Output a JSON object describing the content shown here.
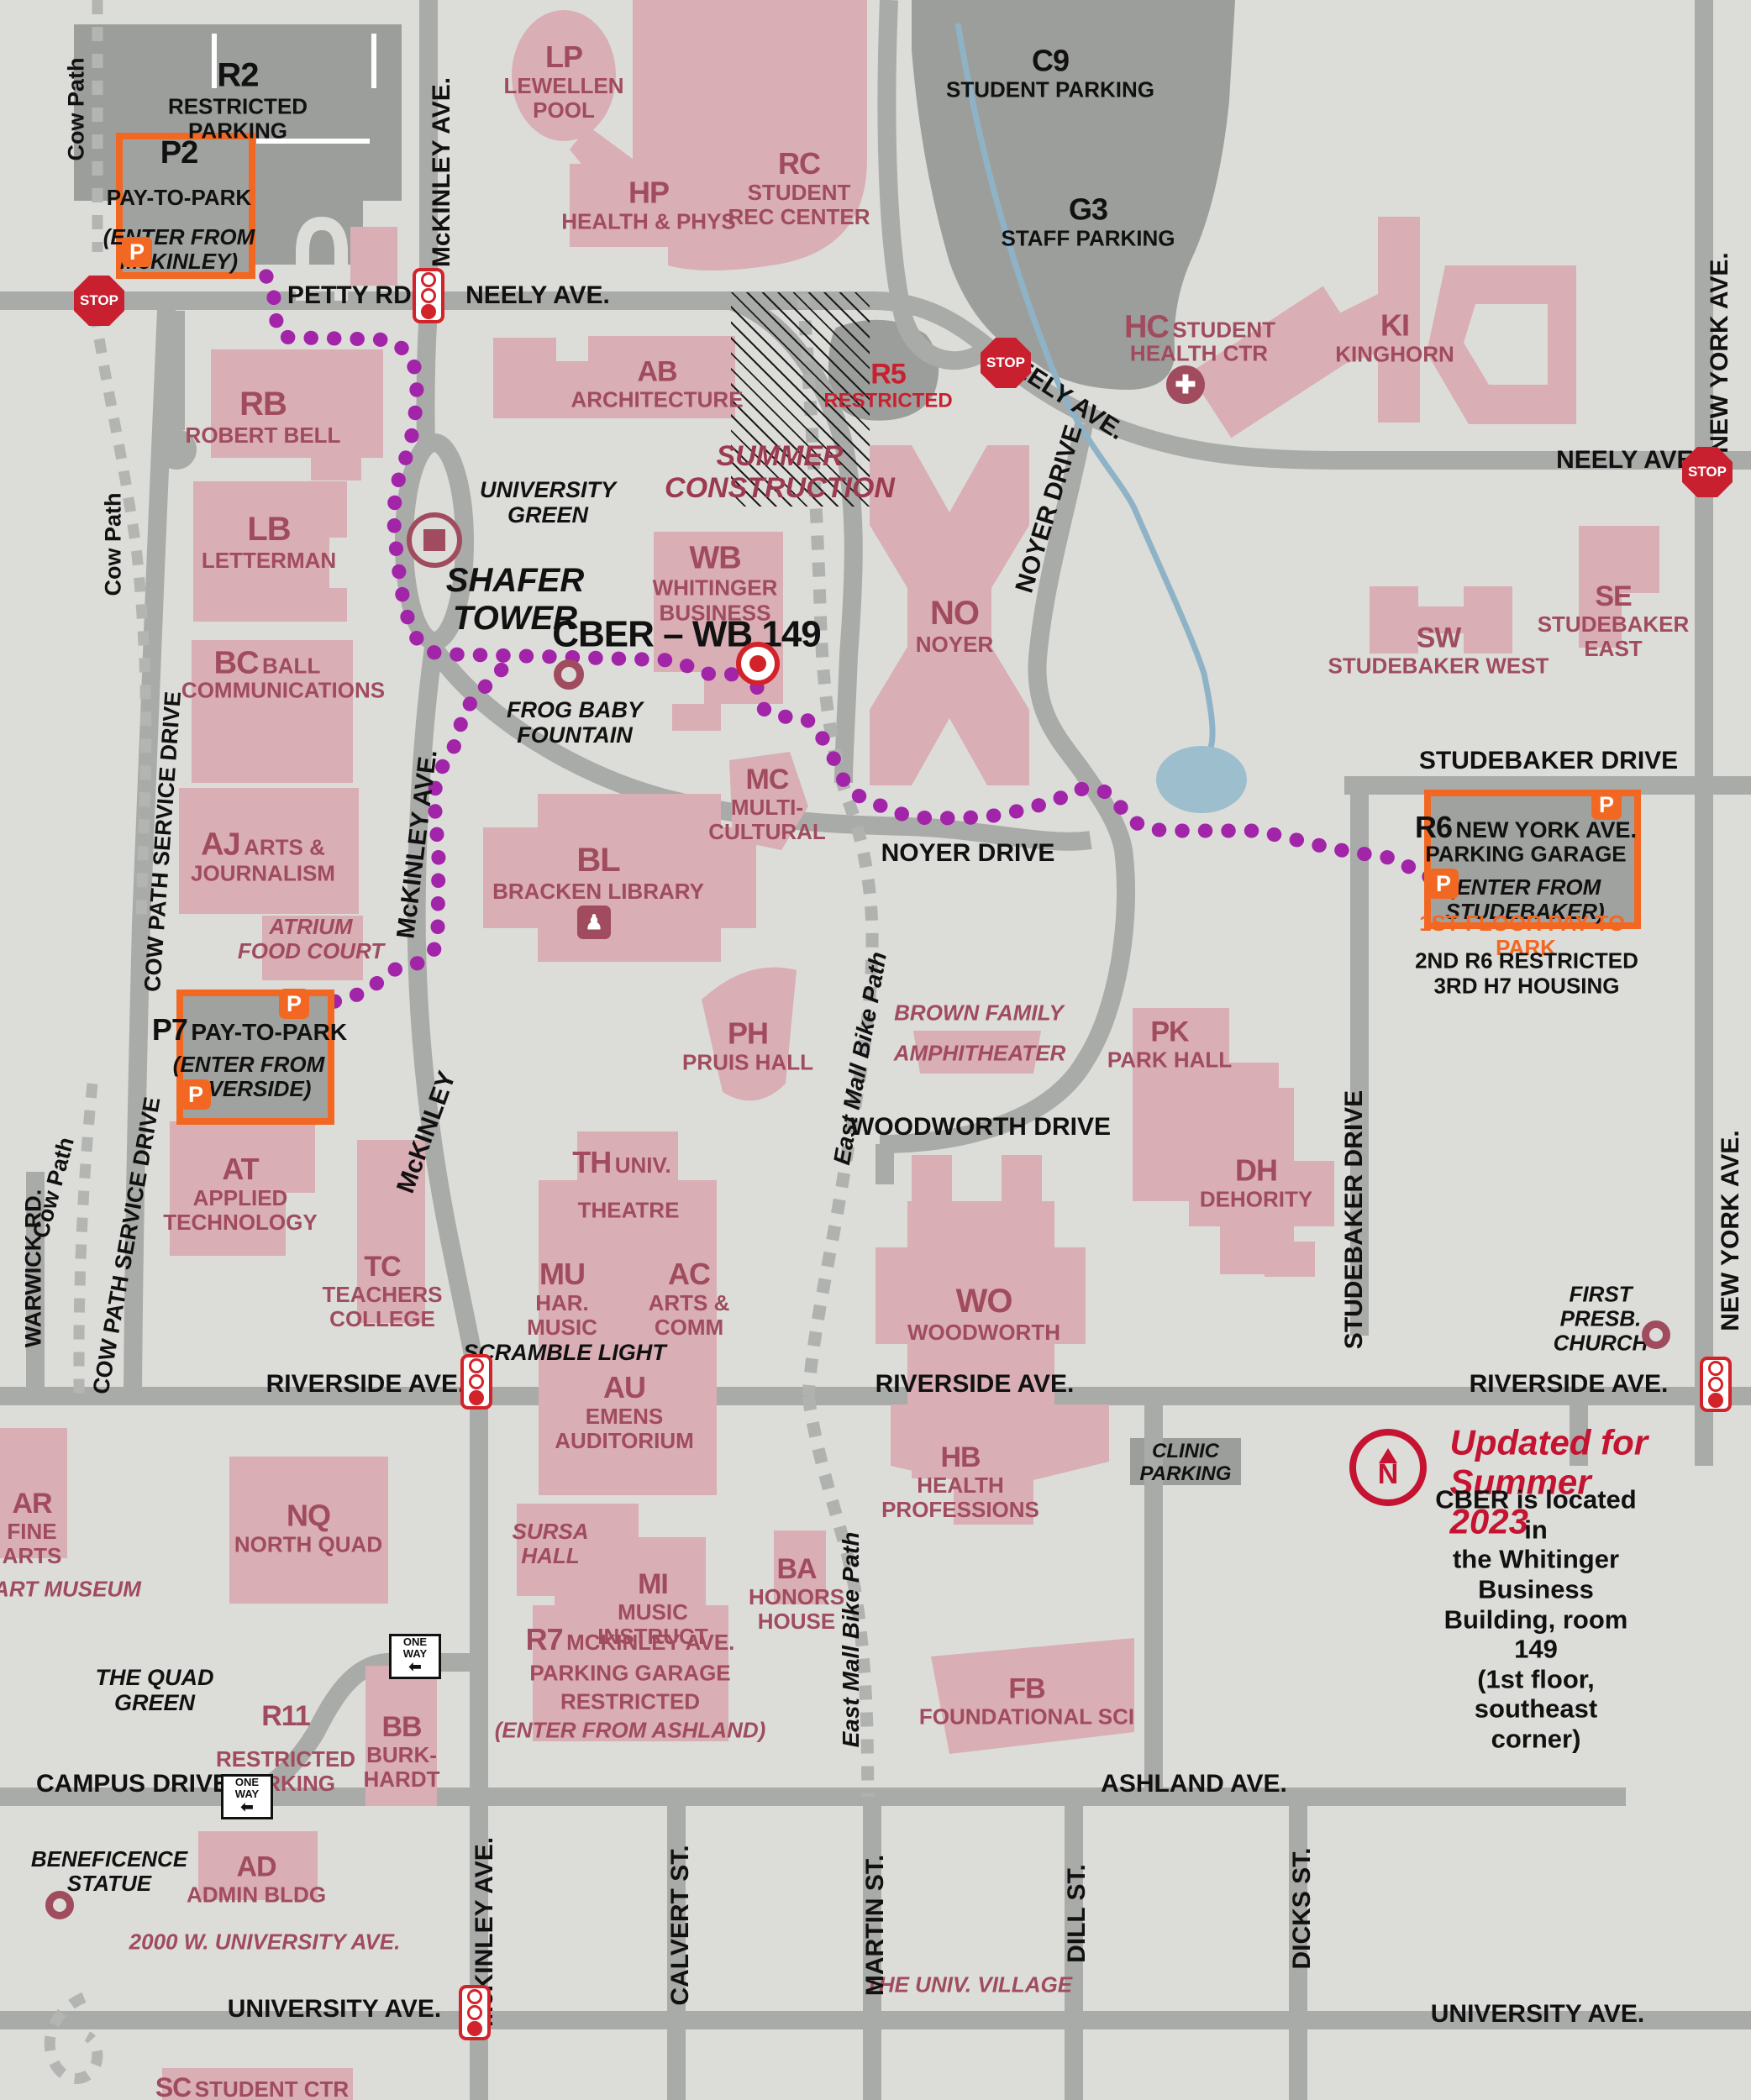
{
  "title": "Ball State University campus map – CBER location",
  "parking": {
    "r2": {
      "code": "R2",
      "name": "RESTRICTED\nPARKING"
    },
    "p2": {
      "code": "P2",
      "name": "PAY-TO-PARK",
      "note": "(ENTER FROM\nMcKINLEY)"
    },
    "c9": {
      "code": "C9",
      "name": "STUDENT PARKING"
    },
    "g3": {
      "code": "G3",
      "name": "STAFF PARKING"
    },
    "r5": {
      "code": "R5",
      "name": "RESTRICTED"
    },
    "p7": {
      "code": "P7",
      "name": "PAY-TO-PARK",
      "note1": "(ENTER FROM",
      "note2": "RIVERSIDE)"
    },
    "r6": {
      "code": "R6",
      "name": "NEW YORK AVE.",
      "line2": "PARKING GARAGE",
      "note1": "(ENTER FROM",
      "note2": "STUDEBAKER)",
      "floor1": "1ST FLOOR PAY-TO-PARK",
      "floor2": "2ND R6 RESTRICTED",
      "floor3": "3RD H7 HOUSING"
    },
    "r7": {
      "code": "R7",
      "name": "MCKINLEY AVE.",
      "line2": "PARKING GARAGE",
      "line3": "RESTRICTED",
      "note": "(ENTER FROM ASHLAND)"
    },
    "r11": {
      "code": "R11",
      "name": "RESTRICTED",
      "name2": "PARKING"
    },
    "clinic": "CLINIC\nPARKING"
  },
  "buildings": {
    "lp": {
      "code": "LP",
      "name": "LEWELLEN\nPOOL"
    },
    "hp": {
      "code": "HP",
      "name": "HEALTH & PHYS"
    },
    "rc": {
      "code": "RC",
      "name": "STUDENT\nREC CENTER"
    },
    "ab": {
      "code": "AB",
      "name": "ARCHITECTURE"
    },
    "rb": {
      "code": "RB",
      "name": "ROBERT BELL"
    },
    "lb": {
      "code": "LB",
      "name": "LETTERMAN"
    },
    "bc": {
      "code": "BC",
      "name": "BALL",
      "line2": "COMMUNICATIONS"
    },
    "aj": {
      "code": "AJ",
      "name": "ARTS &",
      "line2": "JOURNALISM"
    },
    "wb": {
      "code": "WB",
      "name": "WHITINGER\nBUSINESS"
    },
    "mc": {
      "code": "MC",
      "name": "MULTI-\nCULTURAL"
    },
    "no": {
      "code": "NO",
      "name": "NOYER"
    },
    "hc": {
      "code": "HC",
      "name": "STUDENT",
      "line2": "HEALTH CTR"
    },
    "ki": {
      "code": "KI",
      "name": "KINGHORN"
    },
    "sw": {
      "code": "SW",
      "name": "STUDEBAKER WEST"
    },
    "se": {
      "code": "SE",
      "name": "STUDEBAKER\nEAST"
    },
    "bl": {
      "code": "BL",
      "name": "BRACKEN LIBRARY"
    },
    "ph": {
      "code": "PH",
      "name": "PRUIS HALL"
    },
    "th": {
      "code": "TH",
      "name": "UNIV.",
      "line2": "THEATRE"
    },
    "mu": {
      "code": "MU",
      "name": "HAR.\nMUSIC"
    },
    "ac": {
      "code": "AC",
      "name": "ARTS &\nCOMM"
    },
    "au": {
      "code": "AU",
      "name": "EMENS\nAUDITORIUM"
    },
    "at": {
      "code": "AT",
      "name": "APPLIED\nTECHNOLOGY"
    },
    "tc": {
      "code": "TC",
      "name": "TEACHERS\nCOLLEGE"
    },
    "pk": {
      "code": "PK",
      "name": "PARK HALL"
    },
    "wo": {
      "code": "WO",
      "name": "WOODWORTH"
    },
    "dh": {
      "code": "DH",
      "name": "DEHORITY"
    },
    "hb": {
      "code": "HB",
      "name": "HEALTH\nPROFESSIONS"
    },
    "nq": {
      "code": "NQ",
      "name": "NORTH QUAD"
    },
    "ar": {
      "code": "AR",
      "name": "FINE\nARTS"
    },
    "mi": {
      "code": "MI",
      "name": "MUSIC\nINSTRUCT"
    },
    "ba": {
      "code": "BA",
      "name": "HONORS\nHOUSE"
    },
    "bb": {
      "code": "BB",
      "name": "BURK-\nHARDT"
    },
    "ad": {
      "code": "AD",
      "name": "ADMIN BLDG"
    },
    "fb": {
      "code": "FB",
      "name": "FOUNDATIONAL SCI"
    },
    "sc": {
      "code": "SC",
      "name": "STUDENT CTR"
    }
  },
  "poi": {
    "shafer": "SHAFER\nTOWER",
    "university_green": "UNIVERSITY\nGREEN",
    "frog_baby": "FROG BABY\nFOUNTAIN",
    "cber": "CBER – WB 149",
    "summer": "SUMMER\nCONSTRUCTION",
    "amphitheater1": "BROWN FAMILY",
    "amphitheater2": "AMPHITHEATER",
    "atrium": "ATRIUM\nFOOD COURT",
    "art_museum": "ART MUSEUM",
    "quad_green": "THE QUAD\nGREEN",
    "beneficence": "BENEFICENCE\nSTATUE",
    "sursa": "SURSA\nHALL",
    "univ_village": "THE UNIV. VILLAGE",
    "first_presb": "FIRST PRESB.\nCHURCH",
    "scramble": "SCRAMBLE LIGHT",
    "address2000": "2000 W. UNIVERSITY AVE."
  },
  "streets": {
    "petty": "PETTY RD.",
    "neely": "NEELY AVE.",
    "mckinley": "McKINLEY AVE.",
    "mckinley_short": "McKINLEY",
    "cow_path": "Cow Path",
    "cow_path_service": "COW PATH SERVICE DRIVE",
    "warwick": "WARWICK RD.",
    "riverside": "RIVERSIDE AVE.",
    "campus": "CAMPUS DRIVE",
    "ashland": "ASHLAND AVE.",
    "university": "UNIVERSITY AVE.",
    "new_york": "NEW YORK AVE.",
    "studebaker": "STUDEBAKER DRIVE",
    "noyer": "NOYER DRIVE",
    "woodworth": "WOODWORTH DRIVE",
    "east_mall": "East Mall Bike Path",
    "calvert": "CALVERT ST.",
    "martin": "MARTIN ST.",
    "dill": "DILL ST.",
    "dicks": "DICKS ST."
  },
  "info": {
    "updated": "Updated for\nSummer 2023",
    "body": "CBER is located in\nthe Whitinger Business\nBuilding, room 149\n(1st floor, southeast corner)"
  },
  "signs": {
    "stop": "STOP",
    "one_way": "ONE\nWAY",
    "arrow_left": "⬅",
    "p": "P",
    "n": "N",
    "cross": "✚",
    "book": "♟"
  }
}
